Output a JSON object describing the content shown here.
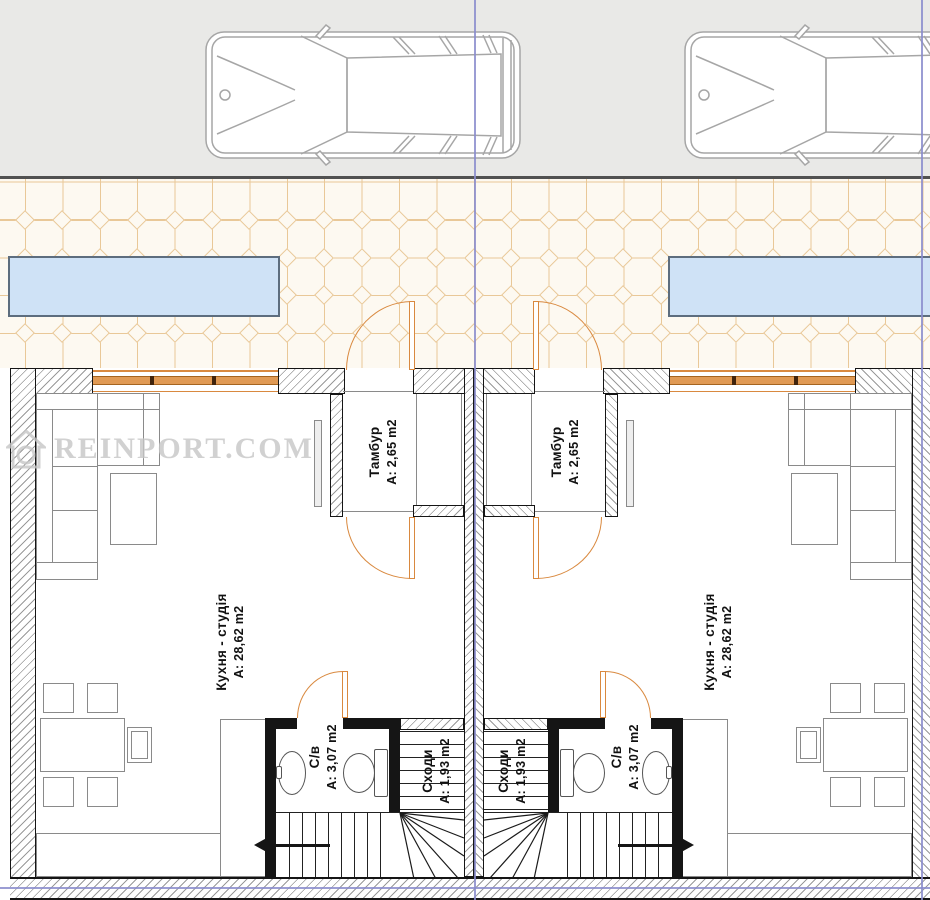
{
  "watermark": {
    "text": "REINPORT.COM"
  },
  "rooms": {
    "vestibule": {
      "name": "Тамбур",
      "area": "A: 2,65 m2"
    },
    "kitchen_studio": {
      "name": "Кухня - студія",
      "area": "A: 28,62 m2"
    },
    "bathroom": {
      "name": "С/в",
      "area": "A: 3,07 m2"
    },
    "stairs": {
      "name": "Сходи",
      "area": "A: 1,93 m2"
    }
  },
  "colors": {
    "parking-bg": "#e9e9e7",
    "paving-bg": "#fdf9f1",
    "tile-line": "#e9c898",
    "canopy-fill": "#cfe2f6",
    "canopy-border": "#5d6d7e",
    "accent-orange": "#d9893f",
    "window-band": "#e09a55",
    "boundary-purple": "#8a8ccd",
    "wall-dark": "#151515",
    "hatch-line": "#9a9a9a",
    "furniture-line": "#8a8a8a",
    "car-line": "#a6a6a6",
    "label-color": "#111111",
    "watermark-color": "#c6c6c6"
  }
}
